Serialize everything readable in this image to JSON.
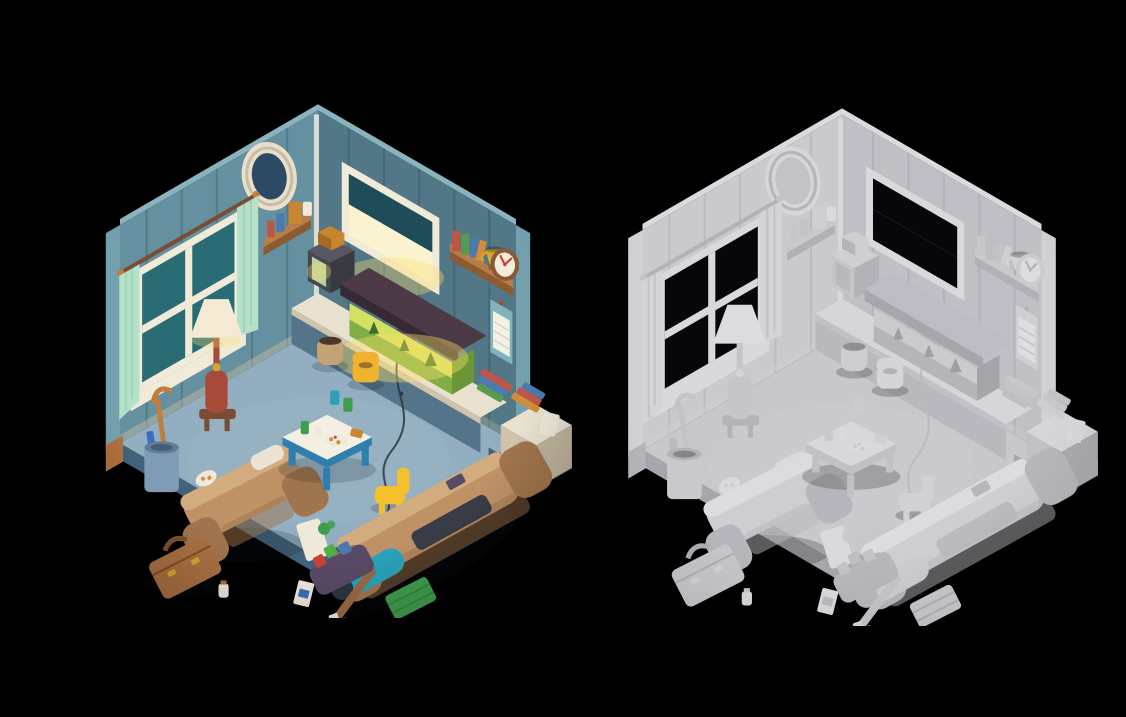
{
  "page": {
    "background_color": "#000000",
    "content_kind": "3d-isometric-room-render-comparison"
  },
  "panels": [
    {
      "name": "textured-render",
      "palette": "textured"
    },
    {
      "name": "clay-render",
      "palette": "clay"
    }
  ],
  "scene_objects": [
    "left-wall",
    "right-wall",
    "oval-mirror",
    "left-window",
    "mint-curtains",
    "curtain-rod",
    "corner-shelf",
    "cereal-box",
    "floor-lamp",
    "lamp-stool",
    "umbrella-stand",
    "cane",
    "armchair",
    "white-blanket",
    "pizza-plate",
    "suitcase",
    "kids-table",
    "food-plate",
    "yellow-potty-chair",
    "yellow-chair",
    "tan-sofa",
    "sleeping-bag",
    "dark-blanket",
    "remote",
    "tv-set",
    "tv-cabinet-counter",
    "game-console",
    "cables",
    "aquarium",
    "aquarium-hood",
    "right-window",
    "trophy-shelf",
    "gold-trophy",
    "books",
    "wall-clock",
    "wall-calendar",
    "white-cabinet",
    "book-stacks",
    "magazine",
    "clay-jar",
    "green-crate",
    "toy-tray",
    "toy-blocks",
    "baseball-bat",
    "cereal-box-floor",
    "playing-cards",
    "green-toy",
    "carpet",
    "floor-base"
  ],
  "palettes": {
    "textured": {
      "wallL": "#64909f",
      "wallR": "#527787",
      "wallCap": "#8ab3bd",
      "wallSide": "#74a0ad",
      "plankLine": "rgba(20,40,50,0.20)",
      "baseTrim": "#d6c4a0",
      "carpet": "#92aec0",
      "floorEdge": "#41627a",
      "baseWood": "#b06f3e",
      "couch": "#bf9266",
      "couchDark": "#a0744c",
      "couchLight": "#d2ab7e",
      "table": "#f4efe3",
      "tableTrim": "#2f7fae",
      "chairYellow": "#f4c12c",
      "lampShade": "#f4ead4",
      "lampBody": "#a84a3a",
      "lampWood": "#7a4c34",
      "curtain": "#b4e2c9",
      "windowFrame": "#f0ead9",
      "glassTeal": "#2a6c74",
      "glassDark": "#1e4c58",
      "glassLit": "#fbf3d0",
      "mirrorFrame": "#eadfc8",
      "mirrorGlass": "#2c4a64",
      "shelfWood": "#b87c46",
      "shelfWoodDark": "#8e5a30",
      "tv": "#46464e",
      "tvTop": "#575762",
      "tvSide": "#3a3a42",
      "tvScreen": "#b6d2a2",
      "tvBox": "#c8862e",
      "tvBoxSide": "#a66a22",
      "aquaRoof": "#4c3a46",
      "aquaRoofDark": "#382a34",
      "tankGlow": "#d4e060",
      "tankGlow2": "#7fae45",
      "tankSide": "#6a9638",
      "plant": "#3c6e2e",
      "counter": "#e9e1cf",
      "counterSide": "#cfc3ab",
      "cabinetSide": "#bfb49e",
      "cabinetBlue": "#54748a",
      "clock": "#8a5a38",
      "clockFace": "#f4ecd8",
      "clockHand": "#c23c30",
      "calendar": "#7fb4ba",
      "calendarPage": "#f4f1e4",
      "trophy": "#d8a62e",
      "potty": "#efb32f",
      "standBlue": "#7e9cb6",
      "standDark": "#5e7e98",
      "cane": "#c07e3e",
      "toolBlue": "#3e6cbe",
      "suitcase": "#aa6f42",
      "suitcaseDark": "#7e4f2c",
      "sleepBag": "#2aa1ba",
      "blanket": "#2c3644",
      "bat": "#996a44",
      "crate": "#3f9e4e",
      "tray": "#584a66",
      "cubeRed": "#c84038",
      "cubeGreen": "#54ae46",
      "bookRed": "#bf5548",
      "bookGreen": "#569a54",
      "bookBlue": "#4a7ab0",
      "bookOrange": "#d28c3a",
      "whiteBox": "#efe9db",
      "jar": "#c3a274",
      "jarHole": "#4a3828",
      "glow": "#ffe066",
      "shadow": "rgba(10,20,30,0.18)",
      "vignette": "0.38"
    },
    "clay": {
      "wallL": "#c9c9ce",
      "wallR": "#bfbfc5",
      "wallCap": "#dadade",
      "wallSide": "#d0d0d5",
      "plankLine": "rgba(70,70,80,0.10)",
      "baseTrim": "#cfcfd4",
      "carpet": "#c7c7cc",
      "floorEdge": "#a6a6ac",
      "baseWood": "#b4b4ba",
      "couch": "#cdcdd2",
      "couchDark": "#b6b6bc",
      "couchLight": "#dcdce0",
      "table": "#d8d8dc",
      "tableTrim": "#c0c0c6",
      "chairYellow": "#d0d0d5",
      "lampShade": "#dcdce0",
      "lampBody": "#c4c4c9",
      "lampWood": "#b2b2b8",
      "curtain": "#d4d4d8",
      "windowFrame": "#d9d9dd",
      "glassTeal": "#070709",
      "glassDark": "#070709",
      "glassLit": "#070709",
      "mirrorFrame": "#d6d6da",
      "mirrorGlass": "#c2c2c7",
      "shelfWood": "#c8c8cd",
      "shelfWoodDark": "#b0b0b6",
      "tv": "#c4c4c9",
      "tvTop": "#ceced3",
      "tvSide": "#b2b2b8",
      "tvScreen": "#b8b8be",
      "tvBox": "#ceced3",
      "tvBoxSide": "#b4b4ba",
      "aquaRoof": "#bcbcc2",
      "aquaRoofDark": "#a6a6ac",
      "tankGlow": "#cacacf",
      "tankGlow2": "#b4b4ba",
      "tankSide": "#a4a4aa",
      "plant": "#9e9ea4",
      "counter": "#d6d6da",
      "counterSide": "#c0c0c6",
      "cabinetSide": "#aaaaaf",
      "cabinetBlue": "#b8b8be",
      "clock": "#cacacf",
      "clockFace": "#dcdce0",
      "clockHand": "#b0b0b6",
      "calendar": "#ceced3",
      "calendarPage": "#dedee2",
      "trophy": "#d2d2d7",
      "potty": "#d4d4d9",
      "standBlue": "#c8c8cd",
      "standDark": "#b2b2b8",
      "cane": "#c2c2c7",
      "toolBlue": "#bababf",
      "suitcase": "#c6c6cb",
      "suitcaseDark": "#aeaeb4",
      "sleepBag": "#cbcbd0",
      "blanket": "#b8b8be",
      "bat": "#c4c4c9",
      "crate": "#c8c8cd",
      "tray": "#b6b6bc",
      "cubeRed": "#c2c2c7",
      "cubeGreen": "#bcbcc2",
      "bookRed": "#c6c6cb",
      "bookGreen": "#bebec4",
      "bookBlue": "#c2c2c7",
      "bookOrange": "#ccccd1",
      "whiteBox": "#dadade",
      "jar": "#ccccd1",
      "jarHole": "#8e8e94",
      "glow": "transparent",
      "shadow": "rgba(0,0,0,0.20)",
      "vignette": "0.16"
    }
  }
}
